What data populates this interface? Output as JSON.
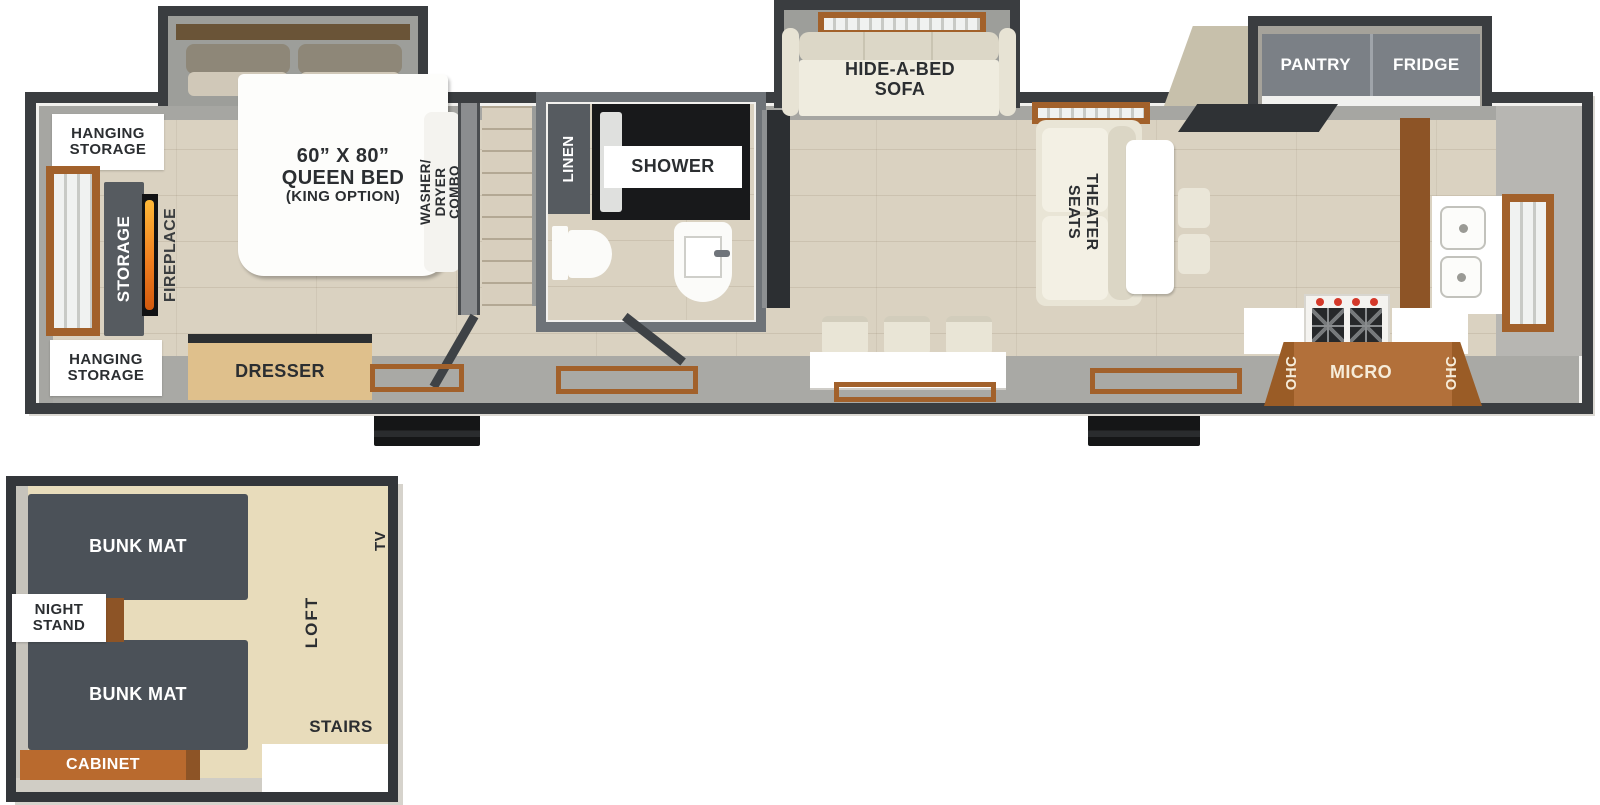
{
  "main_level": {
    "bedroom": {
      "hanging_storage_top": [
        "HANGING",
        "STORAGE"
      ],
      "hanging_storage_bottom": [
        "HANGING",
        "STORAGE"
      ],
      "storage_label": "STORAGE",
      "fireplace_label": "FIREPLACE",
      "bed_size": "60” X 80”",
      "bed_type": "QUEEN BED",
      "bed_option": "(KING OPTION)",
      "washer_dryer": [
        "WASHER/",
        "DRYER",
        "COMBO"
      ],
      "dresser_label": "DRESSER"
    },
    "bathroom": {
      "linen_label": "LINEN",
      "shower_label": "SHOWER"
    },
    "living_room": {
      "sofa_label": [
        "HIDE-A-BED",
        "SOFA"
      ],
      "theater_label": [
        "THEATER",
        "SEATS"
      ]
    },
    "kitchen": {
      "pantry_label": "PANTRY",
      "fridge_label": "FRIDGE",
      "ohc_left_label": "OHC",
      "micro_label": "MICRO",
      "ohc_right_label": "OHC"
    }
  },
  "loft_level": {
    "bunk_top_label": "BUNK MAT",
    "bunk_bottom_label": "BUNK MAT",
    "night_stand": [
      "NIGHT",
      "STAND"
    ],
    "cabinet_label": "CABINET",
    "stairs_label": "STAIRS",
    "loft_label": "LOFT",
    "tv_label": "TV"
  },
  "colors": {
    "wall_dark": "#3a3d40",
    "bath_wall": "#6e7378",
    "wood_floor": "#dad2c1",
    "wood_trim": "#a2612b",
    "cabinet_dark": "#565b60",
    "counter_brown": "#b2703a",
    "cream_furniture": "#e9e5d6",
    "flame_orange": "#f07f1f",
    "bunk_mat": "#4b5158",
    "loft_floor": "#e8dcbb",
    "cabinet_orange": "#b96a2e",
    "label_dark": "#2b2e31"
  }
}
